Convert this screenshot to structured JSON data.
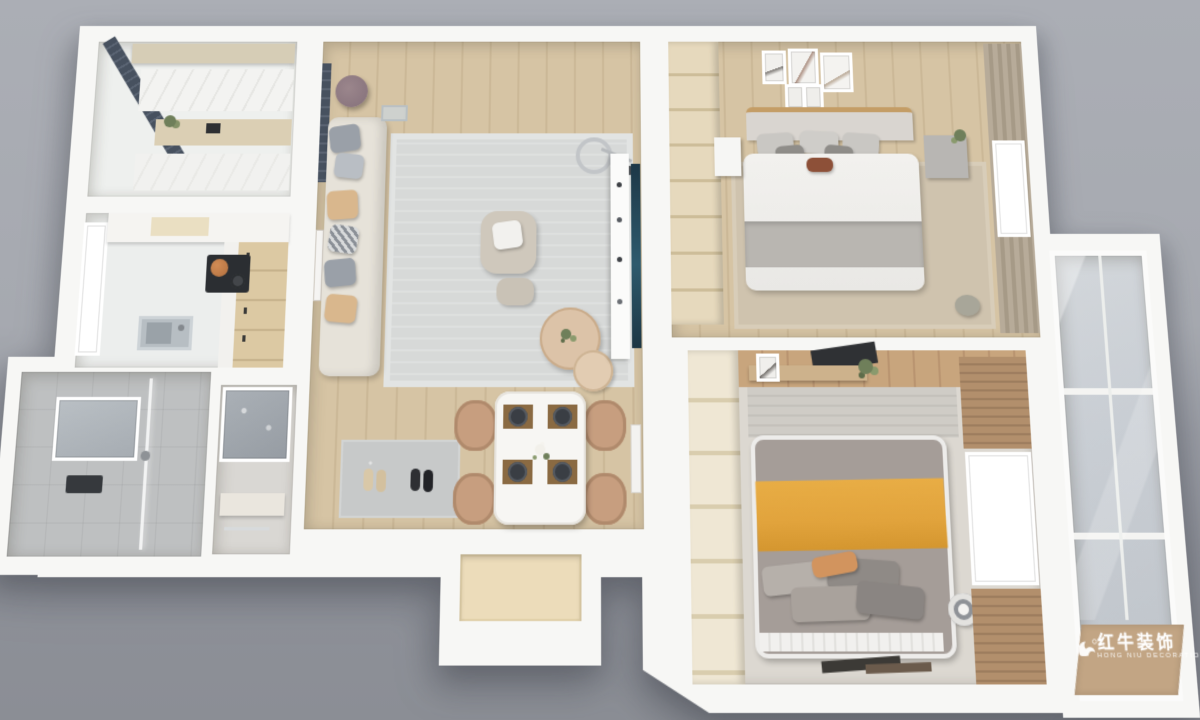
{
  "scene": {
    "kind": "3d-rendered-apartment-floorplan",
    "rooms": [
      {
        "name": "laundry-balcony"
      },
      {
        "name": "kitchen"
      },
      {
        "name": "bathroom"
      },
      {
        "name": "vanity"
      },
      {
        "name": "living-room"
      },
      {
        "name": "dining-area"
      },
      {
        "name": "entry-vestibule"
      },
      {
        "name": "master-bedroom"
      },
      {
        "name": "second-bedroom"
      },
      {
        "name": "glazed-balcony"
      }
    ]
  },
  "watermark": {
    "brand_cn": "红牛装饰",
    "brand_en": "HONG NIU DECORATION",
    "logo": "bull-swoosh-icon"
  },
  "palette": {
    "wall": "#f7f7f5",
    "wood": "#d6c4a4",
    "floor2": "#dcd8d1",
    "rug": "#d7d9d8",
    "rugbeige": "#cfc3ae",
    "sofa": "#e6e2d9",
    "ptan": "#d9b78d",
    "pgray": "#9aa0a8",
    "ctable": "#dcc3a8",
    "chair": "#c79e7f",
    "tv": "#24424f",
    "blind": "#47515f",
    "glass": "#c9ced4",
    "tile": "#bec0c1",
    "cabwood": "#dcc9a3",
    "cooktop": "#2b2e32",
    "copper": "#b2703f",
    "bedwhite": "#f2f1ee",
    "blanketgray": "#b9b6b1",
    "headboard": "#d9d5d0",
    "woodtrim": "#c49d66",
    "curtain": "#b3a896",
    "wardrobe": "#e6d9bd",
    "wardrobe2": "#efe7d4",
    "bed2gray": "#a59d98",
    "yellow": "#e1a33c",
    "orange": "#d2945e",
    "slat": "#b28f6c",
    "wmwood": "#c2a584",
    "mat": "#c7c9c9",
    "door": "#ecdcba",
    "plant": "#6f7f5a",
    "steel": "#b7bec3"
  }
}
